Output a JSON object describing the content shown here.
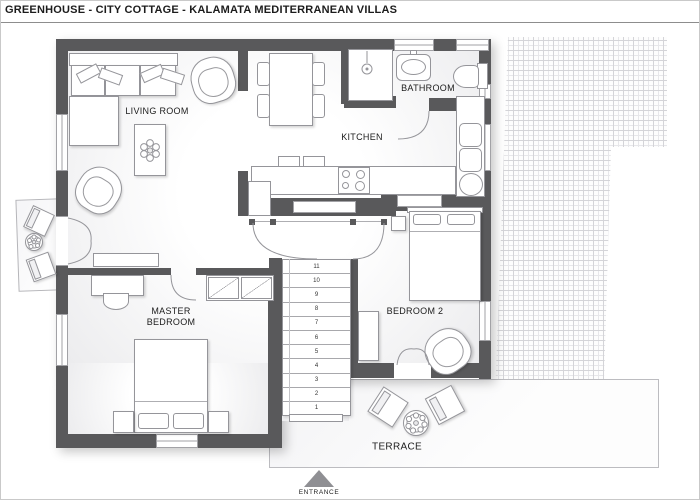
{
  "title": "GREENHOUSE - CITY COTTAGE - KALAMATA MEDITERRANEAN VILLAS",
  "rooms": {
    "living_room": "LIVING ROOM",
    "kitchen": "KITCHEN",
    "bathroom": "BATHROOM",
    "master_bedroom": "MASTER BEDROOM",
    "bedroom2": "BEDROOM 2",
    "terrace": "TERRACE"
  },
  "entrance_label": "ENTRANCE",
  "stairs": {
    "steps": [
      "11",
      "10",
      "9",
      "8",
      "7",
      "6",
      "5",
      "4",
      "3",
      "2",
      "1"
    ]
  },
  "colors": {
    "wall": "#59595b",
    "paver": "#d4d4d8",
    "text": "#1c1c1c",
    "line": "#95959a"
  }
}
